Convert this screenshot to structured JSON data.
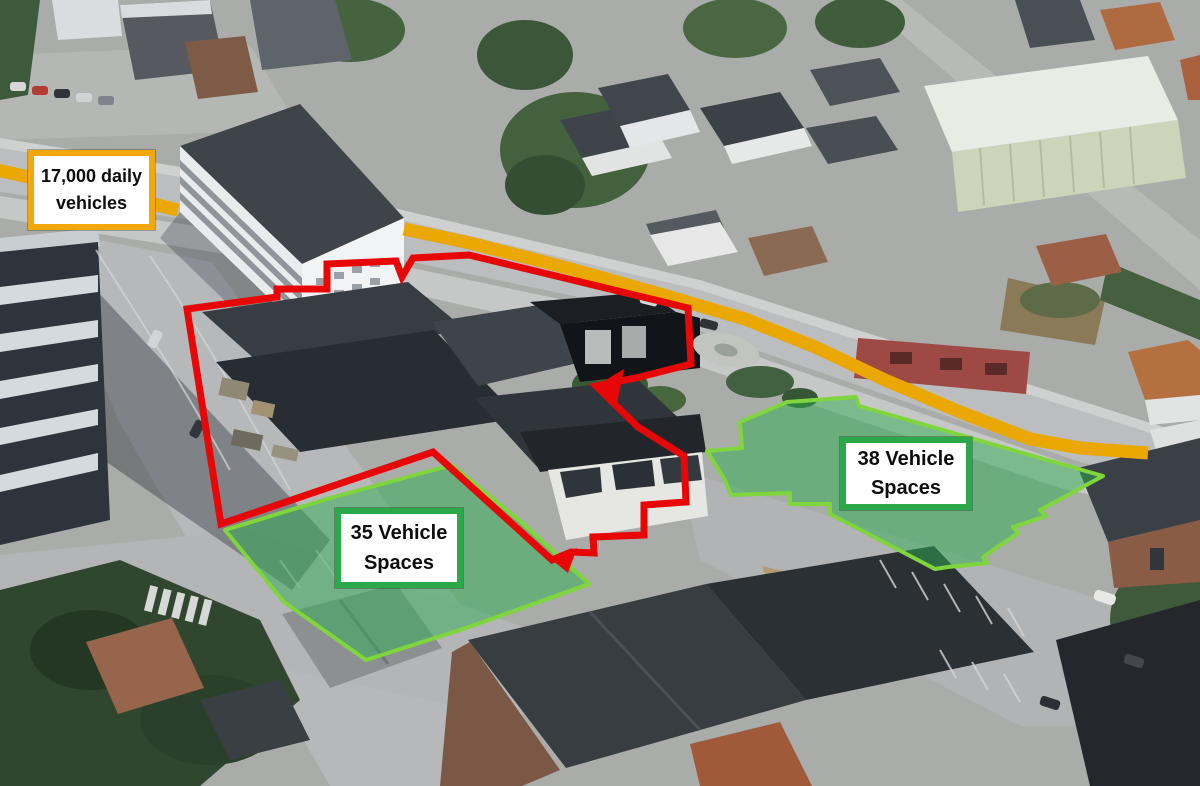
{
  "labels": {
    "traffic": {
      "line1": "17,000 daily",
      "line2": "vehicles",
      "border_color": "#F2A70C"
    },
    "parking_west": {
      "line1": "35 Vehicle",
      "line2": "Spaces",
      "border_color": "#2BA84A"
    },
    "parking_east": {
      "line1": "38 Vehicle",
      "line2": "Spaces",
      "border_color": "#2BA84A"
    }
  },
  "overlay": {
    "highlight_road": {
      "color": "#EBA702",
      "width": 13,
      "segments": [
        {
          "points": [
            [
              -12,
              168
            ],
            [
              60,
              184
            ],
            [
              120,
              196
            ],
            [
              178,
              210
            ]
          ]
        },
        {
          "points": [
            [
              404,
              229
            ],
            [
              470,
              243
            ],
            [
              560,
              266
            ],
            [
              660,
              294
            ],
            [
              745,
              319
            ],
            [
              815,
              347
            ],
            [
              885,
              380
            ],
            [
              960,
              412
            ],
            [
              1030,
              439
            ],
            [
              1080,
              448
            ],
            [
              1148,
              453
            ]
          ]
        }
      ]
    },
    "site_boundary": {
      "color": "#E80707",
      "width": 7,
      "points": [
        [
          187,
          309
        ],
        [
          277,
          297
        ],
        [
          277,
          289
        ],
        [
          327,
          289
        ],
        [
          327,
          264
        ],
        [
          396,
          261
        ],
        [
          402,
          277
        ],
        [
          413,
          258
        ],
        [
          469,
          255
        ],
        [
          556,
          276
        ],
        [
          688,
          308
        ],
        [
          691,
          364
        ],
        [
          640,
          377
        ],
        [
          596,
          386
        ],
        [
          638,
          427
        ],
        [
          684,
          456
        ],
        [
          686,
          502
        ],
        [
          644,
          505
        ],
        [
          644,
          535
        ],
        [
          593,
          537
        ],
        [
          594,
          553
        ],
        [
          571,
          552
        ],
        [
          552,
          560
        ],
        [
          433,
          452
        ],
        [
          221,
          524
        ]
      ],
      "corner_markers": [
        [
          [
            596,
            386
          ],
          [
            624,
            369
          ],
          [
            617,
            403
          ]
        ],
        [
          [
            552,
            560
          ],
          [
            577,
            548
          ],
          [
            568,
            573
          ]
        ]
      ]
    },
    "parking_zones": {
      "fill": "#2FAE54",
      "fill_opacity": 0.5,
      "stroke": "#7FD63C",
      "stroke_width": 4,
      "zones": [
        {
          "name": "parking-zone-35",
          "points": [
            [
              225,
              530
            ],
            [
              330,
              498
            ],
            [
              452,
              465
            ],
            [
              520,
              521
            ],
            [
              589,
              584
            ],
            [
              466,
              628
            ],
            [
              366,
              660
            ],
            [
              284,
              602
            ]
          ]
        },
        {
          "name": "parking-zone-38",
          "points": [
            [
              787,
              402
            ],
            [
              856,
              397
            ],
            [
              859,
              406
            ],
            [
              1103,
              476
            ],
            [
              1040,
              510
            ],
            [
              1046,
              516
            ],
            [
              1013,
              527
            ],
            [
              1018,
              533
            ],
            [
              983,
              557
            ],
            [
              987,
              563
            ],
            [
              948,
              567
            ],
            [
              935,
              569
            ],
            [
              830,
              514
            ],
            [
              830,
              504
            ],
            [
              790,
              504
            ],
            [
              790,
              493
            ],
            [
              731,
              495
            ],
            [
              725,
              480
            ],
            [
              707,
              451
            ],
            [
              742,
              448
            ],
            [
              740,
              422
            ]
          ]
        }
      ]
    }
  }
}
